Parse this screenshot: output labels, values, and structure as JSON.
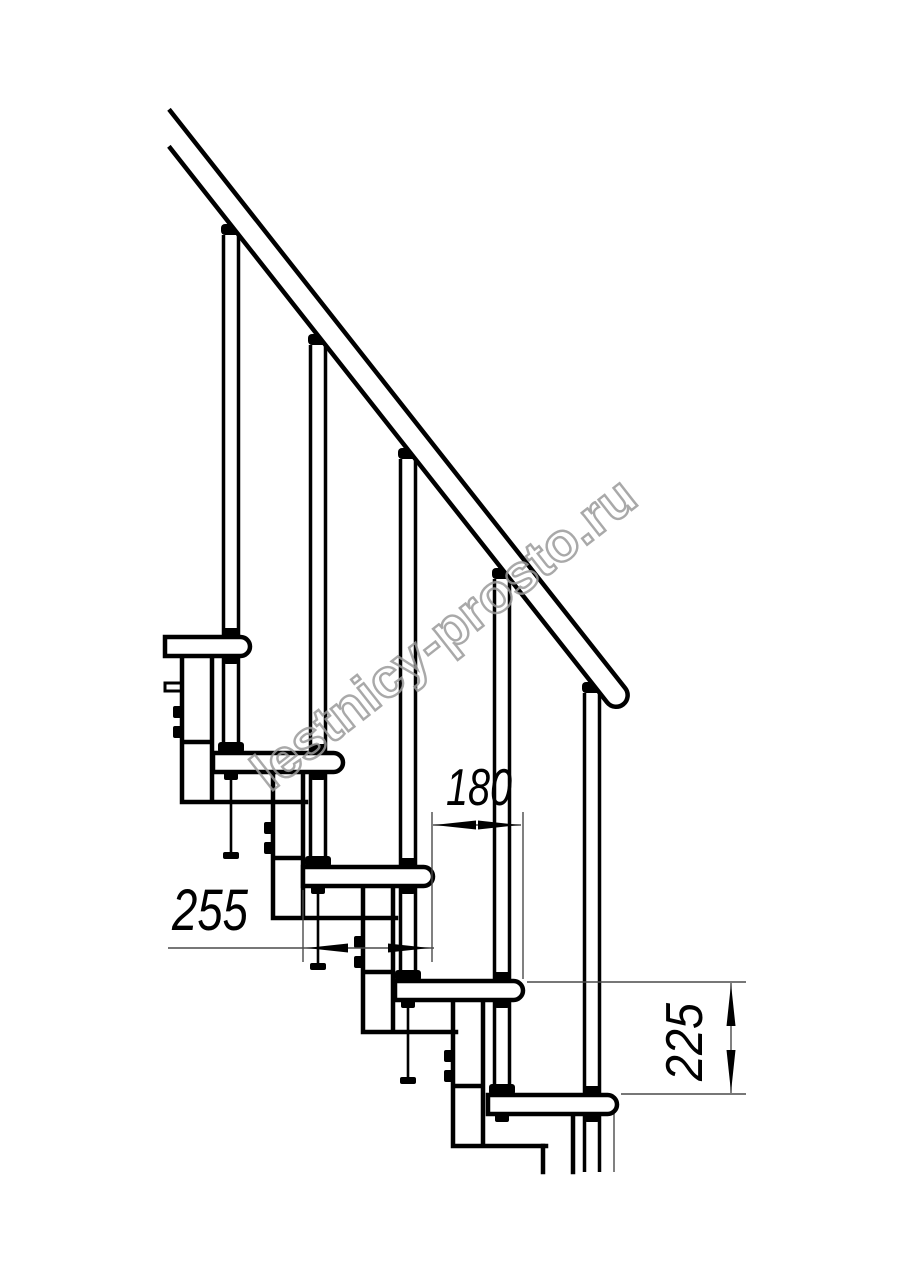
{
  "page": {
    "background": "#ffffff",
    "line_color": "#000000",
    "thin_line_color": "#4a4a4a"
  },
  "watermark": {
    "text": "lestnicy-prosto.ru",
    "color": "#9b9b9b"
  },
  "dimensions": {
    "step_run": {
      "label": "180"
    },
    "tread_depth": {
      "label": "255"
    },
    "step_rise": {
      "label": "225"
    }
  }
}
